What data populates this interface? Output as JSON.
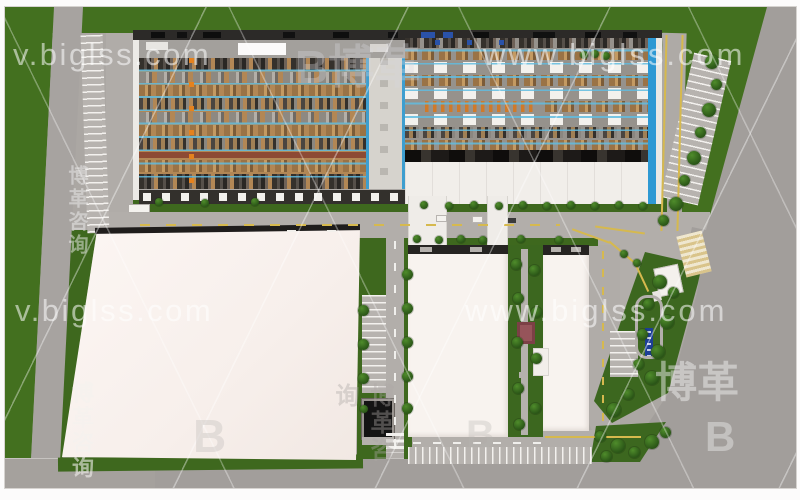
{
  "watermarks": {
    "url_top_left": "v.biglss.com",
    "url_top_right": "www.biglss.com",
    "url_mid_left": "v.biglss.com",
    "url_mid_right": "www.biglss.com",
    "logo_letter": "B",
    "logo_cn": "博革",
    "logo_cn_vertical": "博革咨询"
  },
  "colors": {
    "lawn_green": "#3e681e",
    "road_gray": "#a8a4a0",
    "building_white": "#f8f2ee",
    "factory_floor_tan": "#b28755",
    "aisle_blue": "#55b4e0",
    "machine_orange": "#e5821e",
    "roof_dark": "#2c2a28",
    "sign_blue": "#1d3f96",
    "crosswalk_tan": "#d9c48b"
  }
}
